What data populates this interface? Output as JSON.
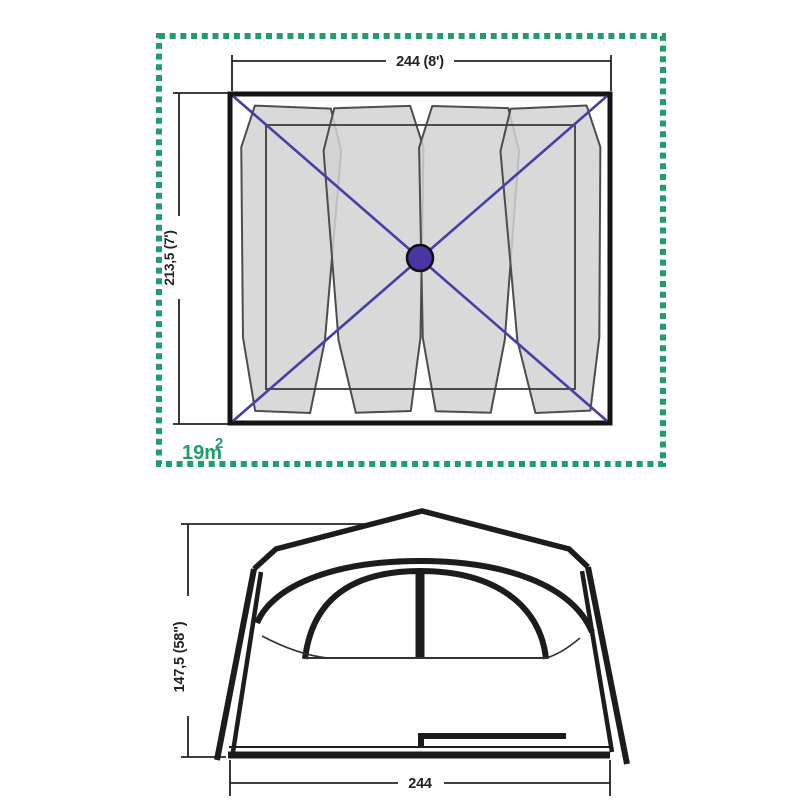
{
  "floor_plan": {
    "width_label": "244 (8')",
    "depth_label": "213,5 (7')",
    "area_value": "19m",
    "area_superscript": "2"
  },
  "elevation": {
    "height_label": "147,5 (58\")",
    "width_label": "244"
  },
  "colors": {
    "dashed_border_green": "#1f9e6c",
    "area_text_green": "#1f9e6c",
    "diagonal_blue": "#453fa8",
    "hub_purple": "#4a35a2",
    "pad_gray": "#d2d2d2",
    "outline_black": "#1c1c1c"
  }
}
